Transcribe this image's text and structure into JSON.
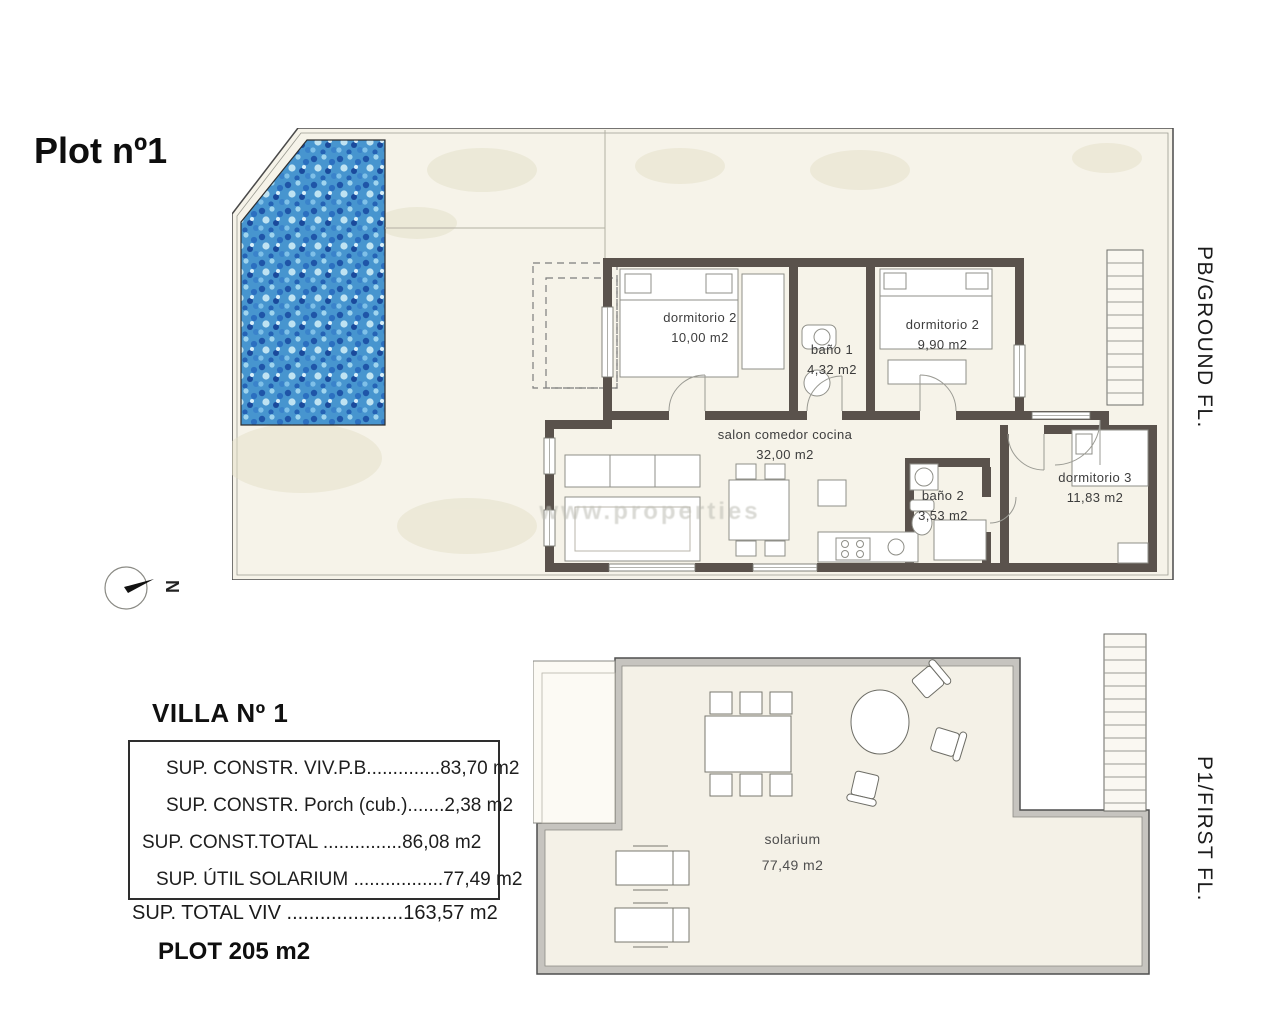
{
  "page": {
    "title": "Plot nº1"
  },
  "floors": {
    "ground": {
      "side_label": "PB/GROUND FL.",
      "rooms": [
        {
          "name": "dormitorio 2",
          "area": "10,00 m2"
        },
        {
          "name": "baño 1",
          "area": "4,32 m2"
        },
        {
          "name": "dormitorio 2",
          "area": "9,90 m2"
        },
        {
          "name": "salon comedor cocina",
          "area": "32,00 m2"
        },
        {
          "name": "baño 2",
          "area": "3,53 m2"
        },
        {
          "name": "dormitorio 3",
          "area": "11,83 m2"
        }
      ]
    },
    "first": {
      "side_label": "P1/FIRST FL.",
      "rooms": [
        {
          "name": "solarium",
          "area": "77,49 m2"
        }
      ]
    }
  },
  "summary": {
    "villa_title": "VILLA Nº 1",
    "rows": [
      "SUP. CONSTR. VIV.P.B..............83,70 m2",
      "SUP. CONSTR. Porch (cub.).......2,38 m2",
      "SUP. CONST.TOTAL ...............86,08 m2",
      "SUP. ÚTIL SOLARIUM .................77,49 m2"
    ],
    "total_row": "SUP. TOTAL VIV .....................163,57 m2",
    "plot_size": "PLOT 205 m2"
  },
  "compass": {
    "label": "N"
  },
  "watermark": "www.properties",
  "colors": {
    "wall_dark": "#5a524c",
    "paper": "#f6f3e9",
    "pool_base": "#4795cf",
    "first_floor_wall": "#c6c4bf"
  }
}
